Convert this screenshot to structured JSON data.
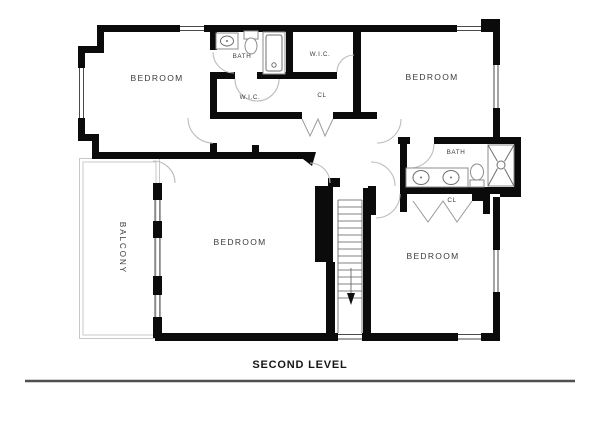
{
  "plan": {
    "title": "SECOND LEVEL",
    "rooms": {
      "bedroom_top_left": "BEDROOM",
      "bedroom_top_right": "BEDROOM",
      "bedroom_center": "BEDROOM",
      "bedroom_bottom_right": "BEDROOM",
      "bath_top": "BATH",
      "bath_right": "BATH",
      "wic_top": "W.I.C.",
      "wic_lower": "W.I.C.",
      "closet_top": "CL",
      "closet_right": "CL",
      "balcony": "BALCONY"
    },
    "stairs": {
      "direction": "down"
    },
    "colors": {
      "wall": "#0b0b0b",
      "door_arc": "#bdbdbd",
      "fixture_outline": "#8d8d8d",
      "balcony_outline": "#c8c8c8",
      "label_text": "#3b3b3b",
      "title_text": "#171717",
      "title_rule": "#4f4f4f",
      "background": "#ffffff"
    }
  }
}
